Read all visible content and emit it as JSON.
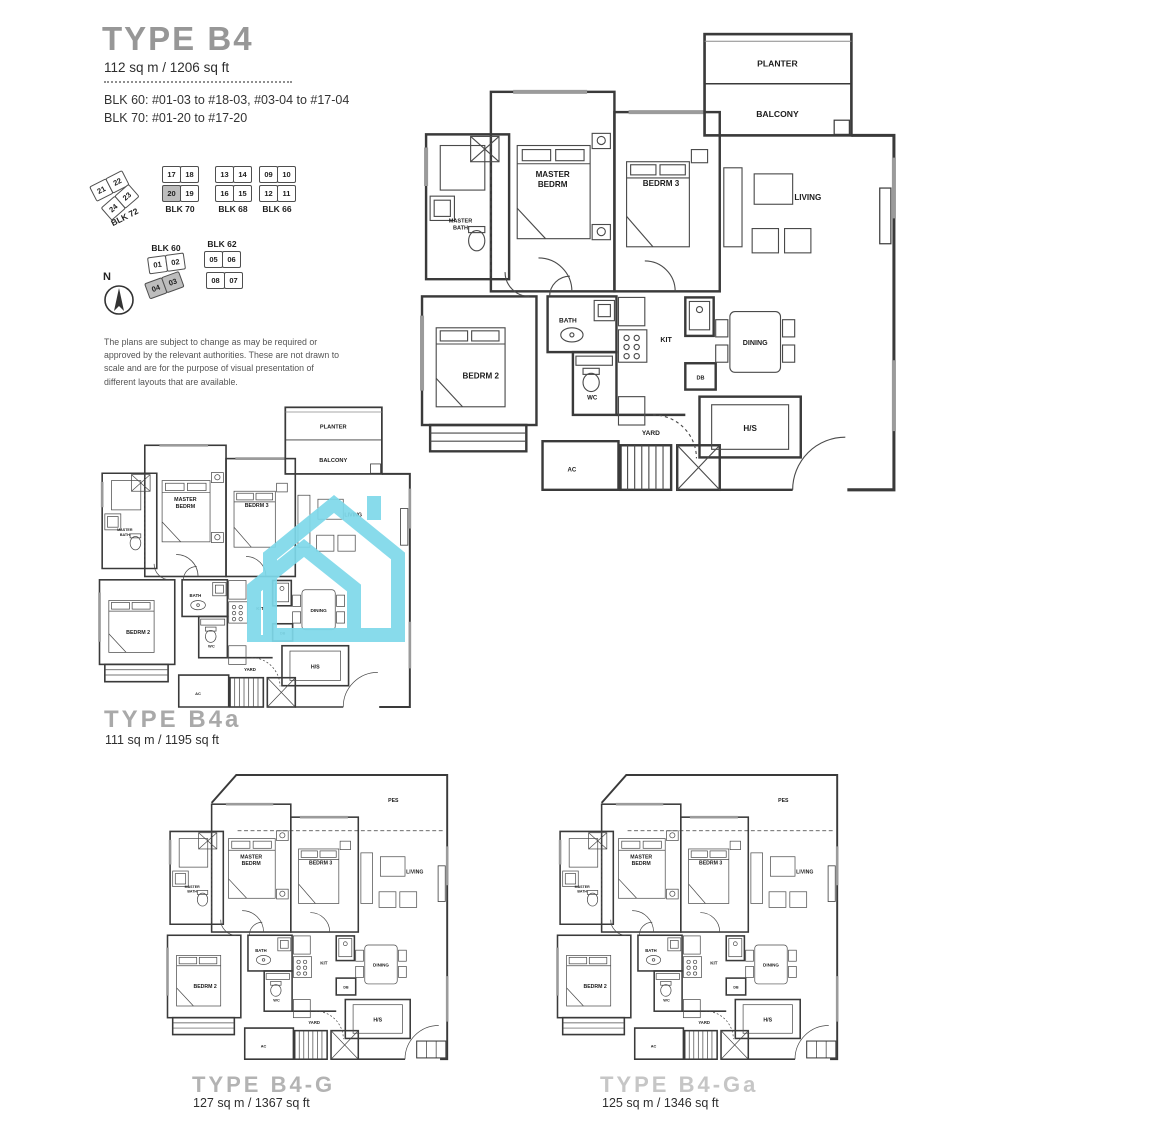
{
  "header": {
    "title": "TYPE B4",
    "area": "112 sq m / 1206 sq ft",
    "blk_line1": "BLK 60: #01-03 to #18-03, #03-04 to #17-04",
    "blk_line2": "BLK 70: #01-20 to #17-20"
  },
  "key": {
    "compass_label": "N",
    "blocks": [
      {
        "label": "BLK 72",
        "units": [
          "21",
          "22",
          "24",
          "23"
        ]
      },
      {
        "label": "BLK 70",
        "units": [
          "17",
          "18",
          "20",
          "19"
        ]
      },
      {
        "label": "BLK 68",
        "units": [
          "13",
          "14",
          "16",
          "15"
        ]
      },
      {
        "label": "BLK 66",
        "units": [
          "09",
          "10",
          "12",
          "11"
        ]
      },
      {
        "label": "BLK 60",
        "units": [
          "01",
          "02",
          "04",
          "03"
        ]
      },
      {
        "label": "BLK 62",
        "units": [
          "05",
          "06",
          "08",
          "07"
        ]
      }
    ]
  },
  "disclaimer": "The plans are subject to change as may be required or approved by the relevant authorities. These are not drawn to scale and are for the purpose of visual presentation of different layouts that are available.",
  "rooms": {
    "master_bedrm_1": "MASTER",
    "master_bedrm_2": "BEDRM",
    "bedrm3": "BEDRM 3",
    "bedrm2": "BEDRM 2",
    "living": "LIVING",
    "dining": "DINING",
    "kit": "KIT",
    "bath": "BATH",
    "wc": "WC",
    "yard": "YARD",
    "hs": "H/S",
    "db": "DB",
    "ac": "AC",
    "master_bath_1": "MASTER",
    "master_bath_2": "BATH",
    "planter": "PLANTER",
    "balcony": "BALCONY",
    "pes": "PES"
  },
  "plans": {
    "b4a": {
      "name": "TYPE B4a",
      "area": "111 sq m / 1195 sq ft"
    },
    "b4g": {
      "name": "TYPE B4-G",
      "area": "127 sq m / 1367 sq ft"
    },
    "b4ga": {
      "name": "TYPE B4-Ga",
      "area": "125 sq m / 1346 sq ft"
    }
  },
  "colors": {
    "watermark": "#7ed9ea",
    "wall": "#3a3a3a"
  }
}
